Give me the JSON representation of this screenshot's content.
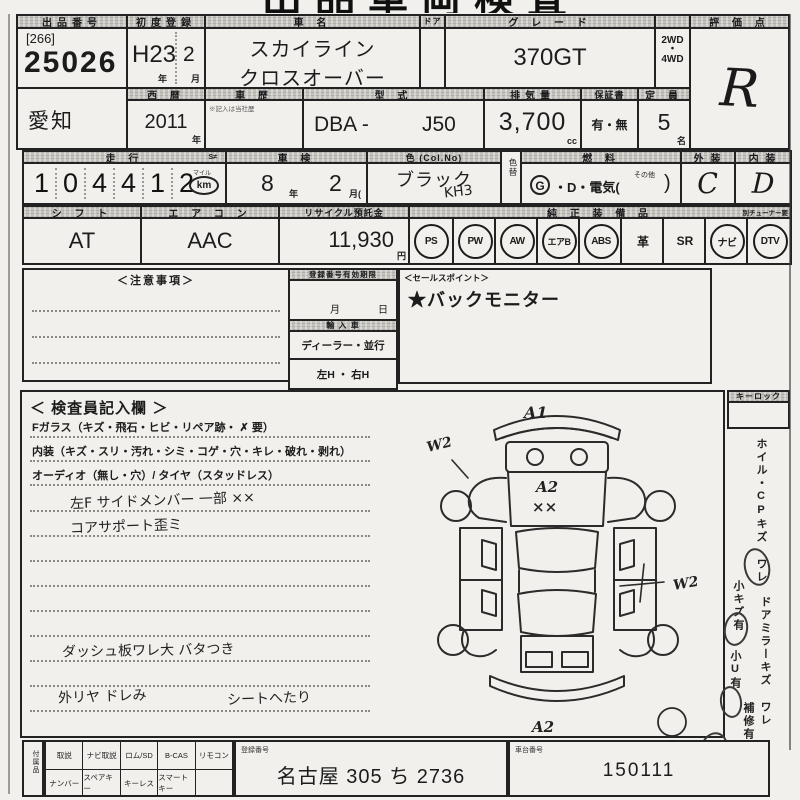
{
  "sheet_title": "出品車両検査票",
  "top": {
    "lot_label": "出品番号",
    "lot_bracket": "[266]",
    "lot_number": "25026",
    "first_reg_label": "初度登録",
    "first_reg_era": "H23",
    "first_reg_month": "2",
    "unit_year": "年",
    "unit_month": "月",
    "name_label": "車  名",
    "name_line1": "スカイライン",
    "name_line2": "クロスオーバー",
    "door_label": "ドア",
    "grade_label": "グ レ ー ド",
    "grade_value": "370GT",
    "drive_top": "2WD",
    "drive_dot": "・",
    "drive_bottom": "4WD",
    "score_label": "評 価 点",
    "score_value": "R",
    "region_value": "愛知",
    "calendar_label": "西 暦",
    "calendar_value": "2011",
    "history_label": "車 歴",
    "history_note": "※記入は当社歴",
    "model_label": "型 式",
    "model_prefix": "DBA -",
    "model_value": "J50",
    "disp_label": "排気量",
    "disp_value": "3,700",
    "disp_unit": "cc",
    "warranty_label": "保証書",
    "warranty_value": "有・無",
    "capacity_label": "定 員",
    "capacity_value": "5",
    "capacity_unit": "名"
  },
  "usage": {
    "mileage_label": "走  行",
    "mileage_s": "S≠",
    "digits": [
      "1",
      "0",
      "4",
      "4",
      "1",
      "2"
    ],
    "mile_label": "マイル",
    "km_label": "km",
    "shaken_label": "車  検",
    "shaken_year": "8",
    "shaken_month": "2",
    "month_paren": "月(",
    "color_label": "色 (Col.No)",
    "color_value": "ブラック",
    "color_code": "KH3",
    "color_change_label": "色替",
    "fuel_label": "燃  料",
    "fuel_g": "G",
    "fuel_mid": "・D・電気(",
    "fuel_other": "その他",
    "fuel_close": ")",
    "ext_label": "外 装",
    "ext_value": "C",
    "int_label": "内 装",
    "int_value": "D"
  },
  "spec": {
    "shift_label": "シ フ ト",
    "shift_value": "AT",
    "aircon_label": "エ ア コ ン",
    "aircon_value": "AAC",
    "recycle_label": "リサイクル預託金",
    "recycle_value": "11,930",
    "recycle_unit": "円",
    "equip_label": "純 正 装 備 品",
    "tuner_note": "別チューナー要",
    "equipment": [
      {
        "label": "PS",
        "circled": true
      },
      {
        "label": "PW",
        "circled": true
      },
      {
        "label": "AW",
        "circled": true
      },
      {
        "label": "エアB",
        "circled": true
      },
      {
        "label": "ABS",
        "circled": true
      },
      {
        "label": "革",
        "circled": false
      },
      {
        "label": "SR",
        "circled": false
      },
      {
        "label": "ナビ",
        "circled": true
      },
      {
        "label": "DTV",
        "circled": true
      }
    ]
  },
  "middle": {
    "caution_label": "＜注意事項＞",
    "validity_label": "登録番号有効期限",
    "validity_month": "月",
    "validity_day": "日",
    "import_label": "輸 入 車",
    "import_options": "ディーラー・並行",
    "handle_options": "左H ・ 右H",
    "sales_label": "＜セールスポイント＞",
    "sales_value": "★バックモニター"
  },
  "inspector": {
    "title": "＜ 検査員記入欄 ＞",
    "line_glass": "Fガラス（キズ・飛石・ヒビ・リペア跡・ ✗ 要）",
    "line_interior": "内装（キズ・スリ・汚れ・シミ・コゲ・穴・キレ・破れ・剥れ）",
    "line_audio": "オーディオ（無し・穴）/ タイヤ（スタッドレス）",
    "hand_note1": "左F サイドメンバー 一部 ××",
    "hand_note2": "コアサポート歪ミ",
    "hand_note3": "ダッシュ板ワレ大 バタつき",
    "hand_note4": "外リヤ ドレみ",
    "hand_note5": "シートへたり"
  },
  "diagram": {
    "mark_front": "A1",
    "mark_left_fender": "W2",
    "mark_hood": "A2",
    "mark_hood_xx": "××",
    "mark_right_side": "W2",
    "mark_rear": "A2"
  },
  "sidebar": {
    "keylock_label": "キーロック",
    "wheel_note": "ホイル・CPキズ ワレ",
    "small_scratch_note": "小キズ有",
    "door_mirror_note": "ドアミラーキズ ワレ",
    "small_dent_note": "小U有",
    "repair_note": "補修有"
  },
  "footer": {
    "acc_label": "付属品",
    "acc_row1": [
      "取説",
      "ナビ取説",
      "ロム/SD",
      "B-CAS",
      "リモコン"
    ],
    "acc_row2": [
      "ナンバー",
      "スペアキー",
      "キーレス",
      "スマートキー",
      ""
    ],
    "reg_label": "登録番号",
    "reg_value": "名古屋 305 ち 2736",
    "chassis_label": "車台番号",
    "chassis_value": "150111"
  }
}
